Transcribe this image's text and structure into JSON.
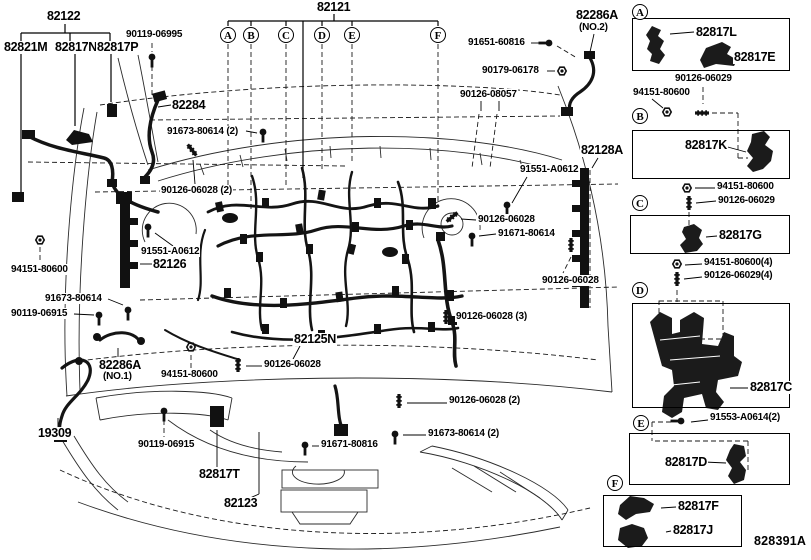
{
  "figure_code": "828391A",
  "assembly": {
    "main_harness": "82121",
    "sub_harness_group": "82122",
    "sub_harness_members": [
      "82821M",
      "82817N",
      "82817P"
    ],
    "connector_points": [
      "A",
      "B",
      "C",
      "D",
      "E",
      "F"
    ]
  },
  "top_letters": [
    {
      "t": "A",
      "x": 228
    },
    {
      "t": "B",
      "x": 251
    },
    {
      "t": "C",
      "x": 286
    },
    {
      "t": "D",
      "x": 322
    },
    {
      "t": "E",
      "x": 352
    },
    {
      "t": "F",
      "x": 438
    }
  ],
  "main_labels": [
    {
      "t": "82122",
      "x": 46,
      "y": 10,
      "big": 1
    },
    {
      "t": "82821M",
      "x": 3,
      "y": 41,
      "big": 1
    },
    {
      "t": "82817N",
      "x": 54,
      "y": 41,
      "big": 1
    },
    {
      "t": "82817P",
      "x": 96,
      "y": 41,
      "big": 1
    },
    {
      "t": "90119-06995",
      "x": 125,
      "y": 29
    },
    {
      "t": "82121",
      "x": 316,
      "y": 1,
      "big": 1
    },
    {
      "t": "82286A",
      "x": 575,
      "y": 9,
      "big": 1
    },
    {
      "t": "(NO.2)",
      "x": 578,
      "y": 22
    },
    {
      "t": "91651-60816",
      "x": 467,
      "y": 37
    },
    {
      "t": "90179-06178",
      "x": 481,
      "y": 65
    },
    {
      "t": "90126-08057",
      "x": 459,
      "y": 89
    },
    {
      "t": "82284",
      "x": 171,
      "y": 99,
      "big": 1
    },
    {
      "t": "91673-80614 (2)",
      "x": 166,
      "y": 126
    },
    {
      "t": "90126-06028 (2)",
      "x": 160,
      "y": 185
    },
    {
      "t": "82128A",
      "x": 580,
      "y": 144,
      "big": 1
    },
    {
      "t": "91551-A0612",
      "x": 519,
      "y": 164
    },
    {
      "t": "90126-06028",
      "x": 477,
      "y": 214
    },
    {
      "t": "91671-80614",
      "x": 497,
      "y": 228
    },
    {
      "t": "91551-A0612",
      "x": 140,
      "y": 246
    },
    {
      "t": "82126",
      "x": 152,
      "y": 258,
      "big": 1
    },
    {
      "t": "94151-80600",
      "x": 10,
      "y": 264
    },
    {
      "t": "90126-06028",
      "x": 541,
      "y": 275
    },
    {
      "t": "91673-80614",
      "x": 44,
      "y": 293
    },
    {
      "t": "90119-06915",
      "x": 10,
      "y": 308
    },
    {
      "t": "90126-06028 (3)",
      "x": 455,
      "y": 311
    },
    {
      "t": "82125N",
      "x": 293,
      "y": 333,
      "big": 1
    },
    {
      "t": "82286A",
      "x": 98,
      "y": 359,
      "big": 1
    },
    {
      "t": "(NO.1)",
      "x": 102,
      "y": 371
    },
    {
      "t": "94151-80600",
      "x": 160,
      "y": 369
    },
    {
      "t": "90126-06028",
      "x": 263,
      "y": 359
    },
    {
      "t": "90126-06028 (2)",
      "x": 448,
      "y": 395
    },
    {
      "t": "91673-80614 (2)",
      "x": 427,
      "y": 428
    },
    {
      "t": "19309",
      "x": 37,
      "y": 427,
      "big": 1
    },
    {
      "t": "90119-06915",
      "x": 137,
      "y": 439
    },
    {
      "t": "91671-80816",
      "x": 320,
      "y": 439
    },
    {
      "t": "82817T",
      "x": 198,
      "y": 468,
      "big": 1
    },
    {
      "t": "82123",
      "x": 223,
      "y": 497,
      "big": 1
    }
  ],
  "sidebar": {
    "letters": [
      {
        "t": "A",
        "x": 640,
        "y": 12
      },
      {
        "t": "B",
        "x": 640,
        "y": 116
      },
      {
        "t": "C",
        "x": 640,
        "y": 203
      },
      {
        "t": "D",
        "x": 640,
        "y": 290
      },
      {
        "t": "E",
        "x": 641,
        "y": 423
      },
      {
        "t": "F",
        "x": 615,
        "y": 483
      }
    ],
    "labels": [
      {
        "t": "82817L",
        "x": 695,
        "y": 26,
        "big": 1
      },
      {
        "t": "82817E",
        "x": 733,
        "y": 51,
        "big": 1
      },
      {
        "t": "90126-06029",
        "x": 674,
        "y": 73
      },
      {
        "t": "94151-80600",
        "x": 632,
        "y": 87
      },
      {
        "t": "82817K",
        "x": 684,
        "y": 139,
        "big": 1
      },
      {
        "t": "94151-80600",
        "x": 716,
        "y": 181
      },
      {
        "t": "90126-06029",
        "x": 717,
        "y": 195
      },
      {
        "t": "82817G",
        "x": 718,
        "y": 229,
        "big": 1
      },
      {
        "t": "94151-80600(4)",
        "x": 703,
        "y": 257
      },
      {
        "t": "90126-06029(4)",
        "x": 703,
        "y": 270
      },
      {
        "t": "82817C",
        "x": 749,
        "y": 381,
        "big": 1
      },
      {
        "t": "91553-A0614(2)",
        "x": 709,
        "y": 412
      },
      {
        "t": "82817D",
        "x": 664,
        "y": 456,
        "big": 1
      },
      {
        "t": "82817F",
        "x": 677,
        "y": 500,
        "big": 1
      },
      {
        "t": "82817J",
        "x": 672,
        "y": 524,
        "big": 1
      }
    ]
  }
}
